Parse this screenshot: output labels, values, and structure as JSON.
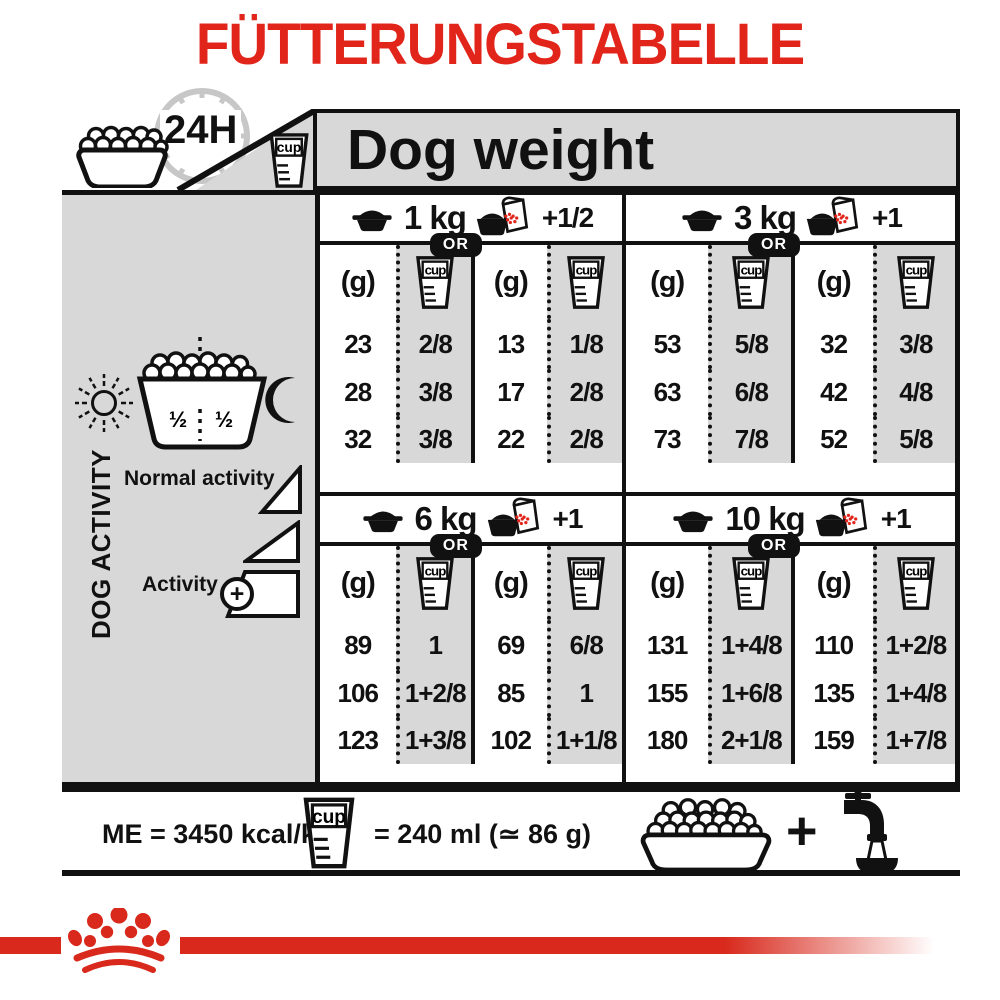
{
  "title": "FÜTTERUNGSTABELLE",
  "labels": {
    "duration": "24H",
    "cup": "cup",
    "dog_weight": "Dog weight",
    "grams": "(g)",
    "or": "OR",
    "plus": "+"
  },
  "sidebar": {
    "axis": "DOG ACTIVITY",
    "half_left": "½",
    "half_right": "½",
    "normal": "Normal activity",
    "active": "Activity",
    "active_plus": "+"
  },
  "footer": {
    "me": "ME = 3450 kcal/kg",
    "equiv": "= 240 ml (≃ 86 g)"
  },
  "colors": {
    "accent_red": "#e2251b",
    "logo_red": "#d8291c",
    "panel_gray": "#d8d8d8",
    "ink": "#111111"
  },
  "chart_data": {
    "type": "table",
    "title": "FÜTTERUNGSTABELLE",
    "column_group_title": "Dog weight",
    "row_group_title": "DOG ACTIVITY",
    "ration_period": "24H",
    "meal_split": [
      "½",
      "½"
    ],
    "activity_levels": [
      "Normal activity",
      "",
      "Activity +"
    ],
    "columns_per_weight": [
      "(g)",
      "cup",
      "(g)",
      "cup"
    ],
    "alternative_note": "OR",
    "sections": [
      {
        "weight": "1 kg",
        "wet_add": "+1/2",
        "rows": [
          [
            "23",
            "2/8",
            "13",
            "1/8"
          ],
          [
            "28",
            "3/8",
            "17",
            "2/8"
          ],
          [
            "32",
            "3/8",
            "22",
            "2/8"
          ]
        ]
      },
      {
        "weight": "3 kg",
        "wet_add": "+1",
        "rows": [
          [
            "53",
            "5/8",
            "32",
            "3/8"
          ],
          [
            "63",
            "6/8",
            "42",
            "4/8"
          ],
          [
            "73",
            "7/8",
            "52",
            "5/8"
          ]
        ]
      },
      {
        "weight": "6 kg",
        "wet_add": "+1",
        "rows": [
          [
            "89",
            "1",
            "69",
            "6/8"
          ],
          [
            "106",
            "1+2/8",
            "85",
            "1"
          ],
          [
            "123",
            "1+3/8",
            "102",
            "1+1/8"
          ]
        ]
      },
      {
        "weight": "10 kg",
        "wet_add": "+1",
        "rows": [
          [
            "131",
            "1+4/8",
            "110",
            "1+2/8"
          ],
          [
            "155",
            "1+6/8",
            "135",
            "1+4/8"
          ],
          [
            "180",
            "2+1/8",
            "159",
            "1+7/8"
          ]
        ]
      }
    ],
    "energy": "ME = 3450 kcal/kg",
    "cup_equivalence": "= 240 ml (≃ 86 g)"
  }
}
